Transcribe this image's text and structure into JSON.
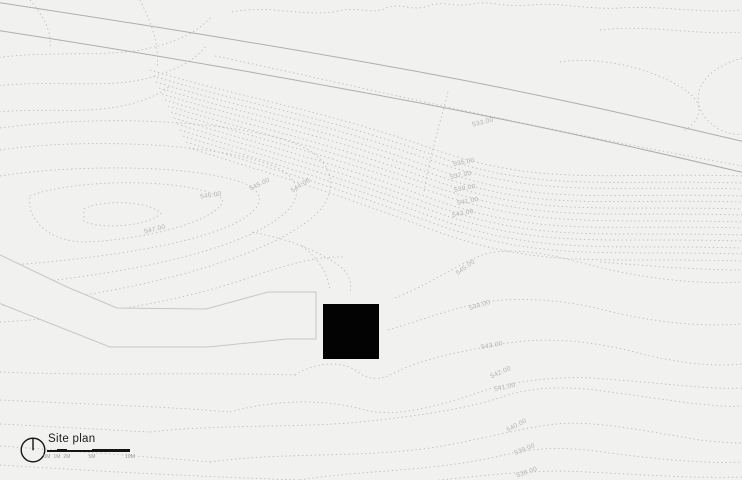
{
  "drawing": {
    "title": "Site plan",
    "scale_bar": {
      "tick_labels": [
        "0M",
        "1M",
        "2M",
        "5M",
        "10M"
      ]
    },
    "contour_labels": [
      "533.00",
      "535.00",
      "537.00",
      "539.00",
      "541.00",
      "543.00",
      "547.00",
      "546.00",
      "545.00",
      "544.00",
      "545.00",
      "544.00",
      "543.00",
      "542.00",
      "541.00",
      "540.00",
      "539.00",
      "538.00"
    ],
    "icons": {
      "north_indicator": "north-indicator-circle-icon"
    }
  },
  "colors": {
    "background": "#f1f1f0",
    "contour_line": "#bdbdbd",
    "road_line": "#aeaeae",
    "site_outline": "#c7c7c7",
    "building_fill": "#030303",
    "elevation_label": "#b3b3b3",
    "ink": "#161616",
    "scale_tick": "#9a9a9a"
  }
}
